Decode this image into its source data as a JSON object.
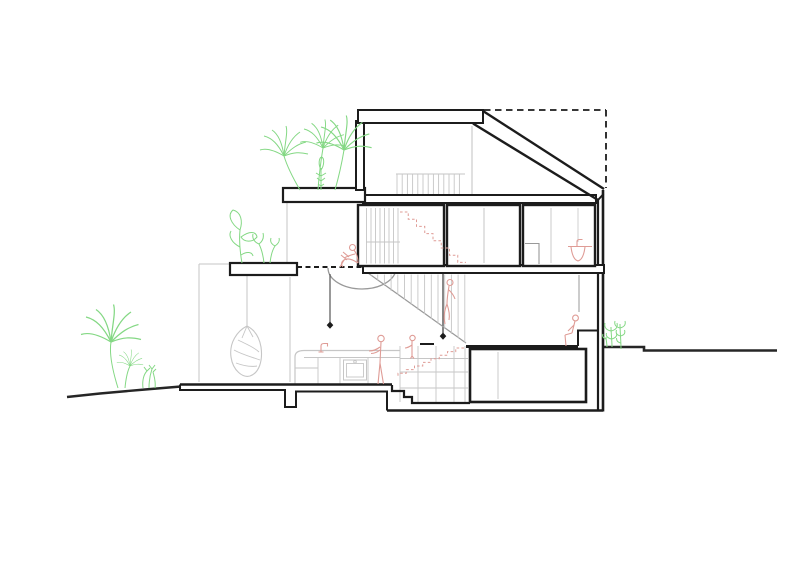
{
  "document": {
    "type": "architectural cross-section drawing of a three-storey house on a sloping site",
    "canvas": {
      "width": 800,
      "height": 565
    }
  },
  "palette": {
    "paper": "#ffffff",
    "ink": "#1c1c1c",
    "terrain": "#262626",
    "gray_light": "#c6c6c6",
    "gray_mid": "#999999",
    "gray_dark": "#555555",
    "green": "#84d884",
    "pink": "#df9c96"
  },
  "elements": {
    "roof": [
      "flat-roof-slab",
      "sloped-roof",
      "dashed-roof-envelope"
    ],
    "levels": [
      "attic",
      "upper-floor",
      "ground-floor",
      "basement"
    ],
    "upper_floor_room_count": 3,
    "stairs": [
      "main-stair-ground-to-upper",
      "dashed-stair-upper-to-attic",
      "dashed-stair-to-basement",
      "entry-steps"
    ],
    "figures": [
      "person-reading-on-landing-edge",
      "person-cooking-at-counter",
      "child-behind-counter",
      "person-climbing-stairs",
      "person-seated-on-step-right"
    ],
    "fixtures": [
      "kitchen-counter-with-oven-and-faucet",
      "bathroom-basin-upper-floor",
      "hanging-egg-chair",
      "pendant-light-left",
      "pendant-light-center",
      "pendant-cord-right",
      "planter-beam",
      "roof-planter-slab"
    ],
    "plants": [
      "roof-terrace-palms",
      "planter-box-foliage",
      "garden-palm-left",
      "shrub-left",
      "seedlings-right"
    ]
  }
}
